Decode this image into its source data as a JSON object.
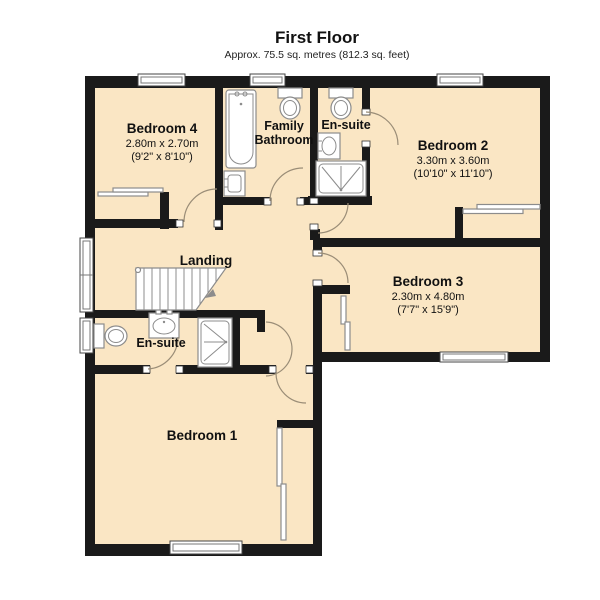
{
  "header": {
    "title": "First Floor",
    "subtitle": "Approx. 75.5 sq. metres (812.3 sq. feet)"
  },
  "rooms": {
    "bedroom4": {
      "name": "Bedroom 4",
      "metric": "2.80m x 2.70m",
      "imperial": "(9'2\" x 8'10\")"
    },
    "family_bathroom": {
      "name_line1": "Family",
      "name_line2": "Bathroom"
    },
    "ensuite_top": {
      "name": "En-suite"
    },
    "bedroom2": {
      "name": "Bedroom 2",
      "metric": "3.30m x 3.60m",
      "imperial": "(10'10\" x 11'10\")"
    },
    "bedroom3": {
      "name": "Bedroom 3",
      "metric": "2.30m x 4.80m",
      "imperial": "(7'7\" x 15'9\")"
    },
    "landing": {
      "name": "Landing"
    },
    "ensuite_bottom": {
      "name": "En-suite"
    },
    "bedroom1": {
      "name": "Bedroom 1"
    }
  },
  "fixtures": [
    "bathtub",
    "toilet",
    "sink",
    "shower",
    "wardrobe",
    "stairs",
    "window",
    "door"
  ],
  "colors": {
    "floor_fill": "#fae6c4",
    "wall": "#1a1a1a",
    "fixture_stroke": "#8c8c8c",
    "door_arc": "#9a8d77",
    "background": "#ffffff"
  }
}
